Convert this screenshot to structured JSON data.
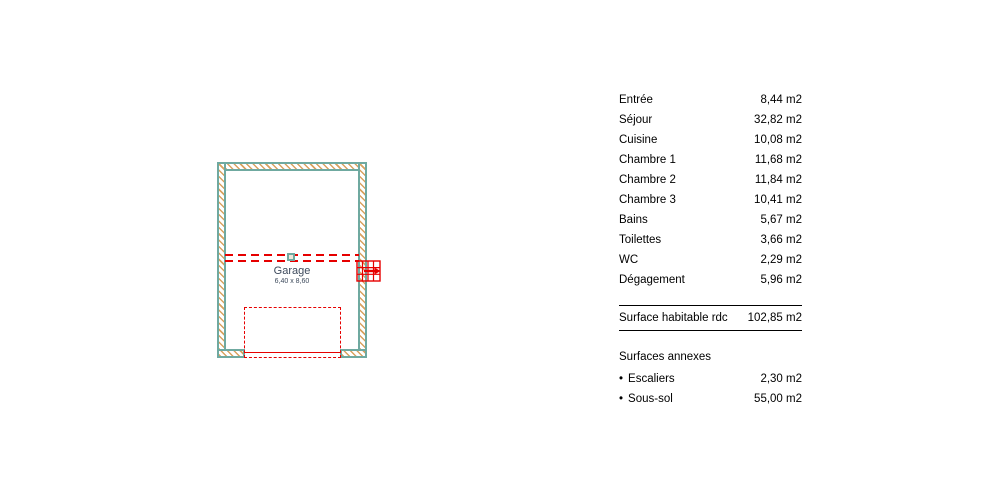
{
  "plan": {
    "room": {
      "label": "Garage",
      "dimensions": "6,40 x 8,60"
    },
    "colors": {
      "wall_teal": "#6FA9A0",
      "hatch_tan": "#D9A25F",
      "annotation_red": "#E60000",
      "room_label_color": "#3D4A5C"
    }
  },
  "areas_table": {
    "rows": [
      {
        "label": "Entrée",
        "value": "8,44 m2"
      },
      {
        "label": "Séjour",
        "value": "32,82 m2"
      },
      {
        "label": "Cuisine",
        "value": "10,08 m2"
      },
      {
        "label": "Chambre 1",
        "value": "11,68 m2"
      },
      {
        "label": "Chambre 2",
        "value": "11,84 m2"
      },
      {
        "label": "Chambre 3",
        "value": "10,41 m2"
      },
      {
        "label": "Bains",
        "value": "5,67 m2"
      },
      {
        "label": "Toilettes",
        "value": "3,66 m2"
      },
      {
        "label": "WC",
        "value": "2,29 m2"
      },
      {
        "label": "Dégagement",
        "value": "5,96 m2"
      }
    ],
    "total": {
      "label": "Surface habitable rdc",
      "value": "102,85 m2"
    },
    "annex": {
      "header": "Surfaces annexes",
      "rows": [
        {
          "bullet": "•",
          "label": "Escaliers",
          "value": "2,30 m2"
        },
        {
          "bullet": "•",
          "label": "Sous-sol",
          "value": "55,00 m2"
        }
      ]
    }
  }
}
